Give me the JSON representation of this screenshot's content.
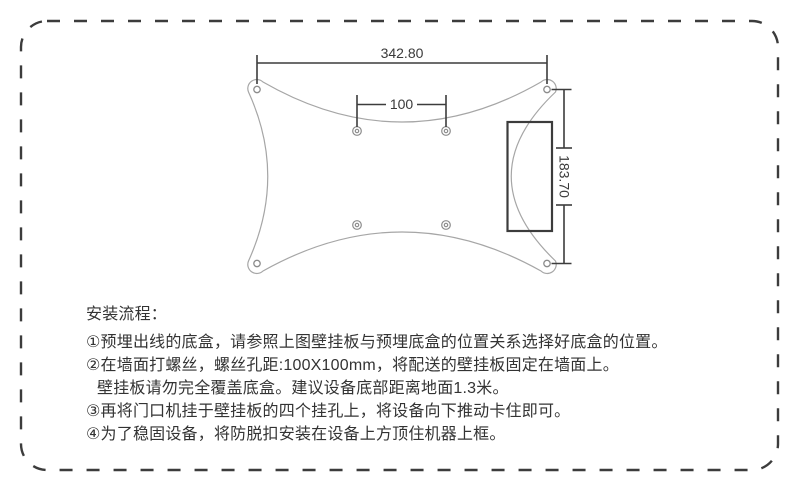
{
  "drawing": {
    "dim_width_label": "342.80",
    "dim_hole_spacing_label": "100",
    "dim_height_label": "183.70"
  },
  "instructions": {
    "title": "安装流程：",
    "lines": [
      "①预埋出线的底盒，请参照上图壁挂板与预埋底盒的位置关系选择好底盒的位置。",
      "②在墙面打螺丝，螺丝孔距:100X100mm，将配送的壁挂板固定在墙面上。",
      "壁挂板请勿完全覆盖底盒。建议设备底部距离地面1.3米。",
      "③再将门口机挂于壁挂板的四个挂孔上，将设备向下推动卡住即可。",
      "④为了稳固设备，将防脱扣安装在设备上方顶住机器上框。"
    ]
  },
  "colors": {
    "border_dark": "#3c3c3c",
    "plate_outline": "#a6a6a6",
    "hole_stroke": "#8c8c8c",
    "text": "#333333"
  }
}
